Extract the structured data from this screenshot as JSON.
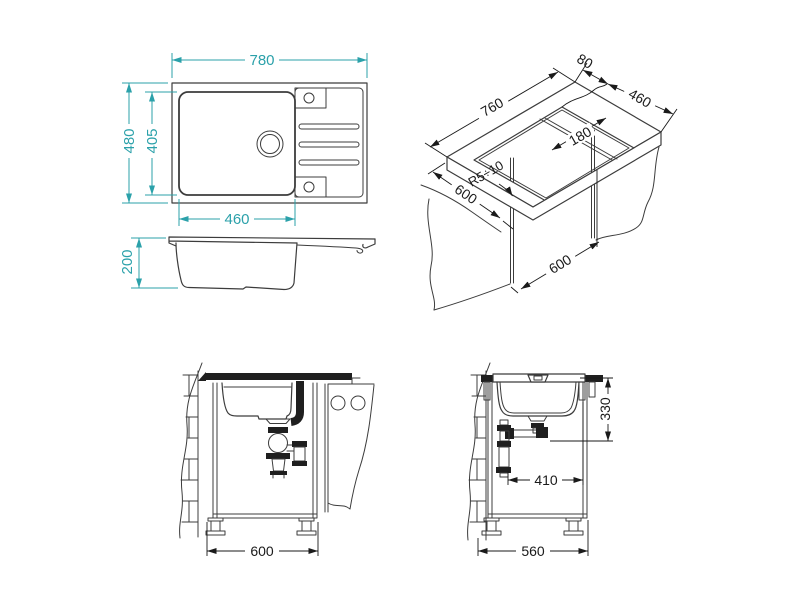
{
  "drawing": {
    "colors": {
      "accent": "#2BA1AA",
      "line": "#3C3C3C",
      "dark": "#1F1F1F",
      "dim": "#1A1A1A"
    },
    "top_view": {
      "width": "780",
      "depth": "480",
      "bowl_length": "460",
      "bowl_depth": "405"
    },
    "side_view": {
      "height": "200"
    },
    "cutout_view": {
      "offset": "80",
      "width": "460",
      "length": "760",
      "divider": "180",
      "radius": "R5÷10",
      "cabinet_width": "600",
      "cabinet_depth": "600"
    },
    "front_view": {
      "cabinet_width": "600"
    },
    "side_install_view": {
      "height": "330",
      "offset": "410",
      "cabinet_width": "560"
    }
  }
}
